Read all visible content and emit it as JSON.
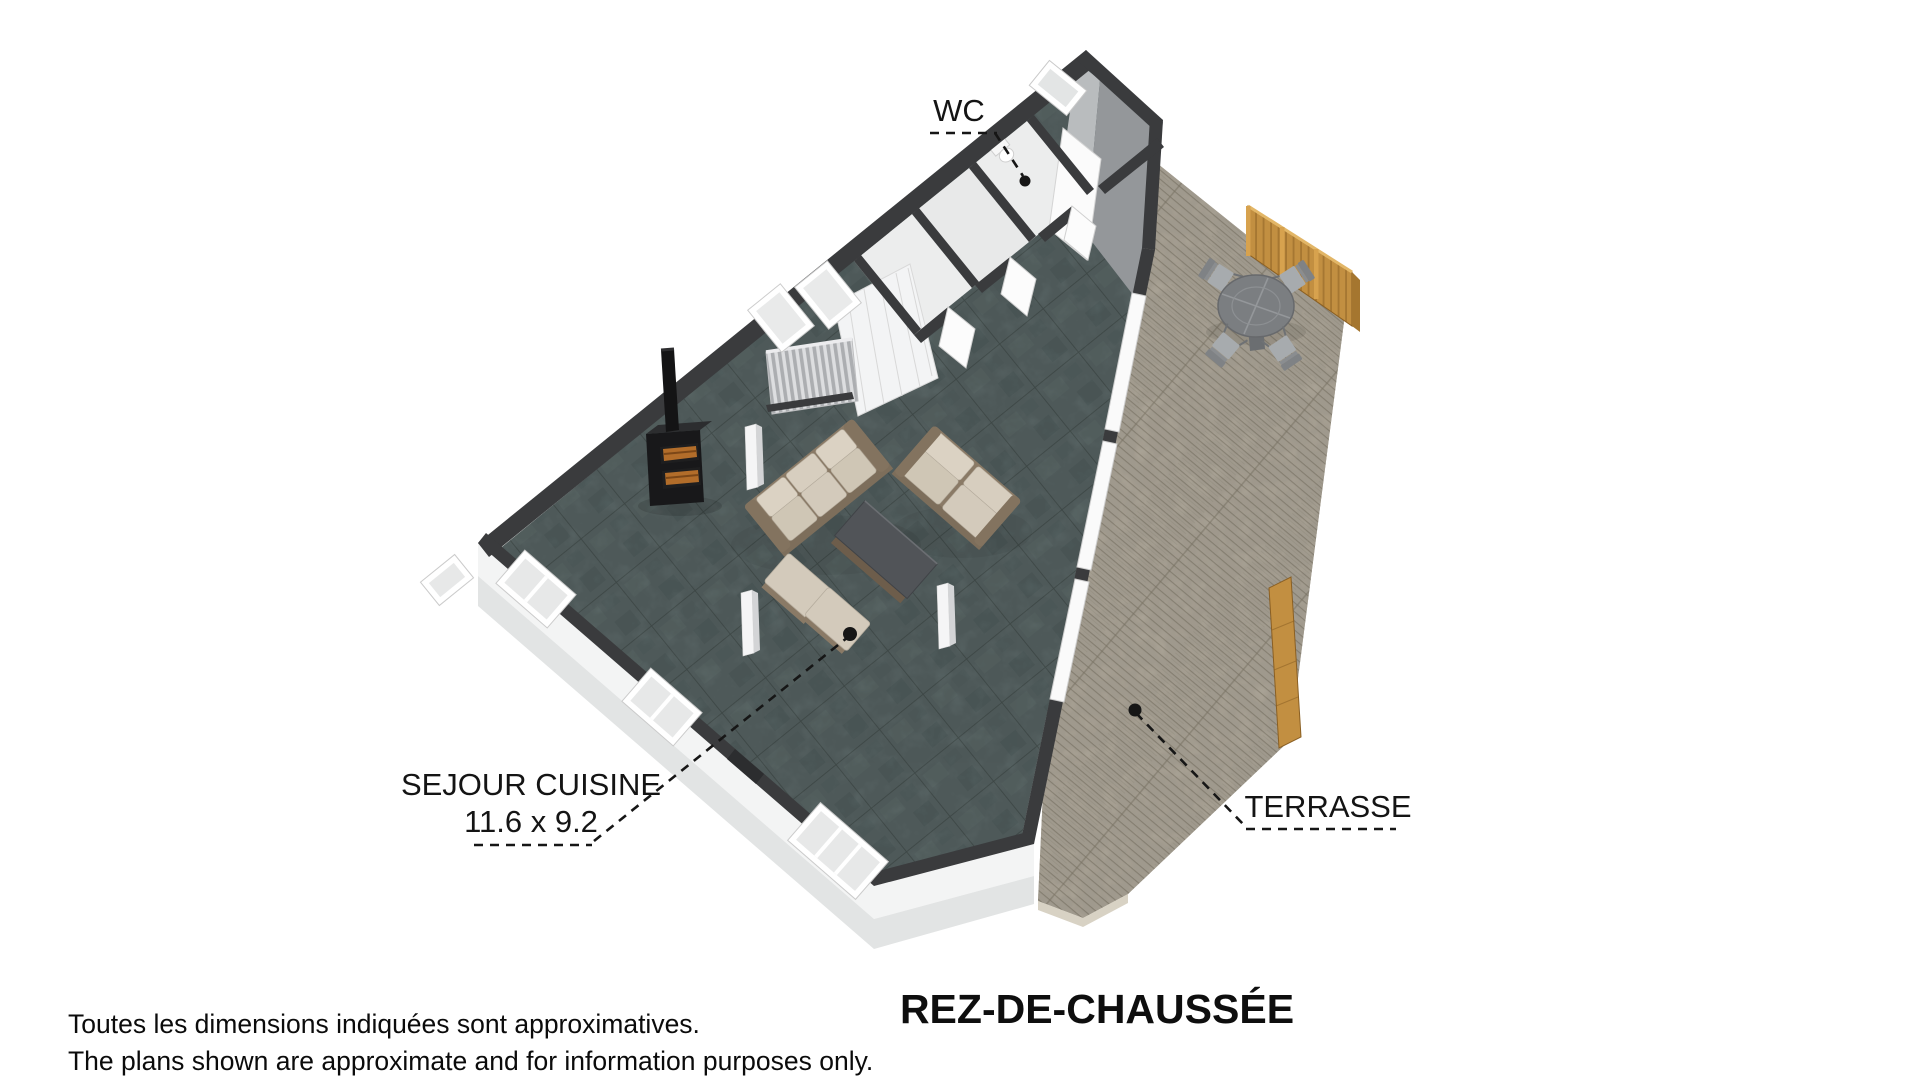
{
  "floor_plan": {
    "title": "REZ-DE-CHAUSSÉE",
    "rooms": [
      {
        "name": "WC"
      },
      {
        "name": "SEJOUR CUISINE",
        "dimensions": "11.6 x 9.2"
      },
      {
        "name": "TERRASSE"
      }
    ]
  },
  "disclaimer": {
    "line1": "Toutes les dimensions indiquées sont approximatives.",
    "line2": "The plans shown are approximate and for information purposes only."
  },
  "colors": {
    "background": "#ffffff",
    "wall": "#3a3b3d",
    "slate_floor": "#5d6a6a",
    "deck_wood": "#b2ab9d",
    "fence_wood": "#c28f41",
    "sofa_cushion": "#d3cabb",
    "sofa_frame": "#8a7a66",
    "annotation": "#161616"
  }
}
